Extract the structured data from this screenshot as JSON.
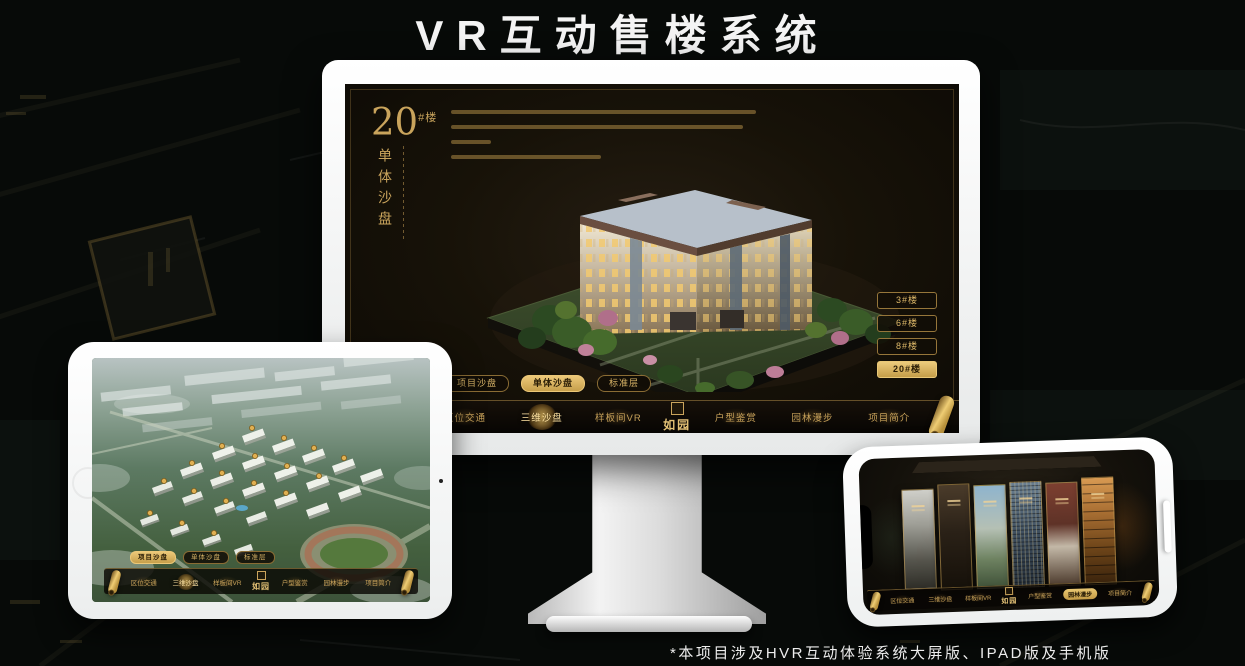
{
  "page": {
    "title": "VR互动售楼系统",
    "footnote": "*本项目涉及HVR互动体验系统大屏版、IPAD版及手机版"
  },
  "colors": {
    "gold": "#C9A45C",
    "gold_active": "#ECC878",
    "screen_bg": "#171208",
    "page_bg": "#070A08",
    "device_white": "#F6F7F7"
  },
  "app": {
    "brand": "如园",
    "nav_items": [
      {
        "label": "区位交通"
      },
      {
        "label": "三维沙盘"
      },
      {
        "label": "样板间VR"
      },
      {
        "label": "户型鉴赏"
      },
      {
        "label": "园林漫步"
      },
      {
        "label": "项目简介"
      }
    ],
    "view_tabs": [
      {
        "label": "项目沙盘"
      },
      {
        "label": "单体沙盘"
      },
      {
        "label": "标准层"
      }
    ]
  },
  "monitor_screen": {
    "building_number": "20",
    "building_number_suffix": "#楼",
    "section_title_vertical": "单体沙盘",
    "active_tab": "单体沙盘",
    "active_nav": "三维沙盘",
    "floor_buttons": [
      {
        "label": "3#楼",
        "active": false
      },
      {
        "label": "6#楼",
        "active": false
      },
      {
        "label": "8#楼",
        "active": false
      },
      {
        "label": "20#楼",
        "active": true
      }
    ]
  },
  "ipad_screen": {
    "active_tab": "项目沙盘",
    "active_nav": "三维沙盘"
  },
  "phone_screen": {
    "active_nav": "园林漫步",
    "panel_count": 6
  }
}
